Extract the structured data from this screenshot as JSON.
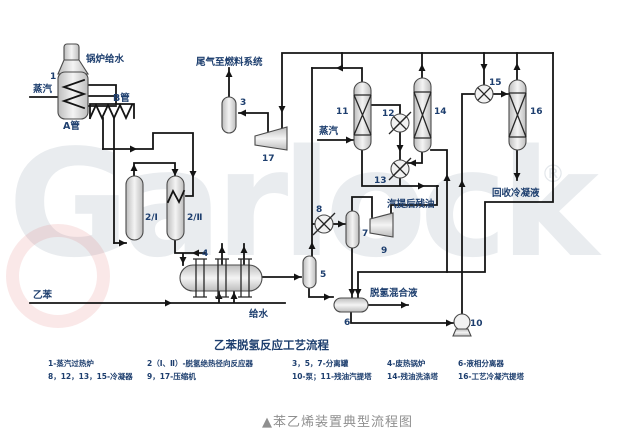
{
  "watermark": {
    "text": "Garlock",
    "registered": "®",
    "color": "#e9ecef"
  },
  "title": "乙苯脱氢反应工艺流程",
  "caption": "▲苯乙烯装置典型流程图",
  "labels": {
    "boiler_feed_water": "锅炉给水",
    "steam_left": "蒸汽",
    "tube_a": "A管",
    "tube_b": "B管",
    "tail_gas_to_fuel": "尾气至燃料系统",
    "steam_mid": "蒸汽",
    "stripped_residual_oil": "汽提后残油",
    "recovered_condensate": "回收冷凝液",
    "dehydro_mixture": "脱氢混合液",
    "ethylbenzene": "乙苯",
    "feed_water": "给水"
  },
  "equipment": {
    "n1": "1",
    "n2a": "2/Ⅰ",
    "n2b": "2/Ⅱ",
    "n3": "3",
    "n4": "4",
    "n5": "5",
    "n6": "6",
    "n7": "7",
    "n8": "8",
    "n9": "9",
    "n10": "10",
    "n11": "11",
    "n12": "12",
    "n13": "13",
    "n14": "14",
    "n15": "15",
    "n16": "16",
    "n17": "17"
  },
  "legend": {
    "r0c0": "1-蒸汽过热炉",
    "r0c1": "2（Ⅰ、Ⅱ）-脱氢绝热径向反应器",
    "r0c2": "3，5，7-分离罐",
    "r0c3": "4-废热锅炉",
    "r0c4": "6-液相分离器",
    "r1c0": "8，12，13，15-冷凝器",
    "r1c1": "9，17-压缩机",
    "r1c2": "10-泵；11-残油汽提塔",
    "r1c3": "14-残油洗涤塔",
    "r1c4": "16-工艺冷凝汽提塔"
  },
  "colors": {
    "label": "#1d3e6e",
    "line": "#141414",
    "caption": "#8f8f8f",
    "equipment_stroke": "#4a4a4a",
    "watermark": "#e9ecef"
  }
}
